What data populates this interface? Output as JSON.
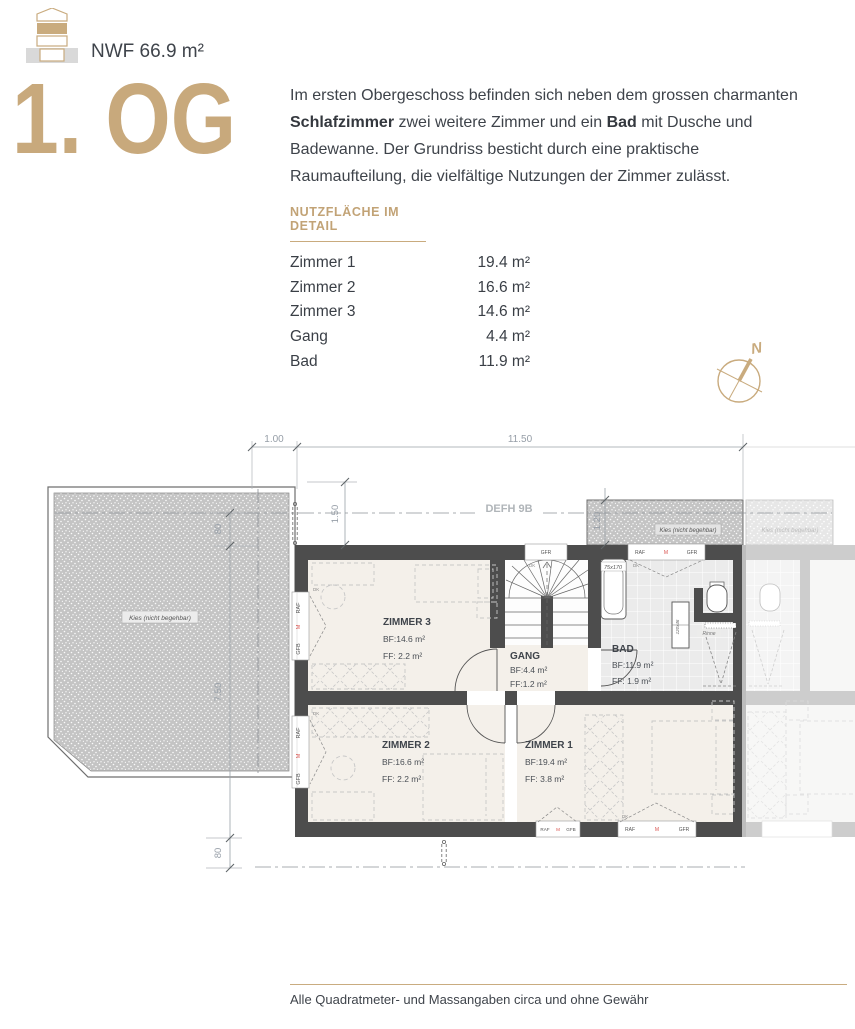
{
  "header": {
    "nwf": "NWF 66.9 m²",
    "floor_title": "1. OG"
  },
  "intro": {
    "p1": "Im ersten Obergeschoss befinden sich neben dem grossen charmanten ",
    "b1": "Schlafzimmer",
    "p2": " zwei weitere Zimmer und ein ",
    "b2": "Bad",
    "p3": " mit Dusche und Badewanne. Der Grundriss besticht durch eine praktische Raumaufteilung, die vielfältige Nutzungen der Zimmer zulässt."
  },
  "area_table": {
    "heading": "NUTZFLÄCHE IM DETAIL",
    "rows": [
      {
        "label": "Zimmer 1",
        "value": "19.4 m²"
      },
      {
        "label": "Zimmer 2",
        "value": "16.6 m²"
      },
      {
        "label": "Zimmer 3",
        "value": "14.6 m²"
      },
      {
        "label": "Gang",
        "value": "4.4 m²"
      },
      {
        "label": "Bad",
        "value": "11.9 m²"
      }
    ]
  },
  "compass": {
    "north": "N"
  },
  "plan": {
    "axis_label": "DEFH 9B",
    "dims": {
      "top_offset": "1.00",
      "top_width": "11.50",
      "upper_inset": "1.50",
      "right_inset": "1.20",
      "left_top": "80",
      "left_depth": "7.50",
      "left_bottom": "80"
    },
    "gravel_label": "Kies (nicht begehbar)",
    "window_labels": {
      "raf": "RAF",
      "m": "M",
      "gfr": "GFR",
      "gfb": "GFB",
      "dk": "DK"
    },
    "fixtures": {
      "tub": "75x170",
      "drain": "Rinne",
      "vanity": "120x46"
    },
    "rooms": [
      {
        "name": "ZIMMER 3",
        "bf": "BF:14.6 m²",
        "ff": "FF: 2.2 m²"
      },
      {
        "name": "GANG",
        "bf": "BF:4.4 m²",
        "ff": "FF:1.2 m²"
      },
      {
        "name": "BAD",
        "bf": "BF:11.9 m²",
        "ff": "FF: 1.9 m²"
      },
      {
        "name": "ZIMMER 2",
        "bf": "BF:16.6 m²",
        "ff": "FF: 2.2 m²"
      },
      {
        "name": "ZIMMER 1",
        "bf": "BF:19.4 m²",
        "ff": "FF: 3.8 m²"
      }
    ]
  },
  "footer": {
    "disclaimer": "Alle Quadratmeter- und Massangaben circa und ohne Gewähr"
  },
  "colors": {
    "accent_tan": "#c8a97c",
    "wall_dark": "#4d4d4d",
    "room_floor": "#f4f0ea",
    "tile": "#ebebeb",
    "gravel": "#c4c4c4",
    "dim_text": "#969ea7",
    "marker_red": "#d9534f",
    "body_text": "#3e434a"
  }
}
